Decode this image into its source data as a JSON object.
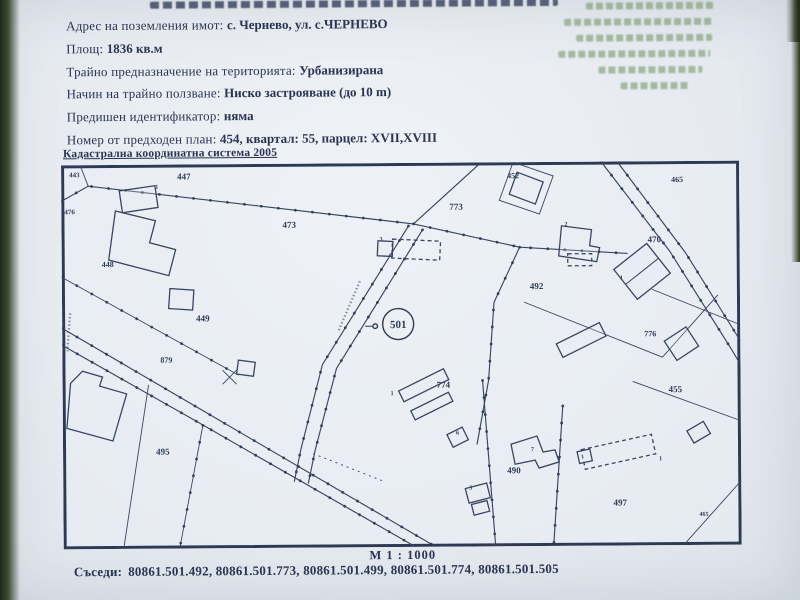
{
  "colors": {
    "paper": "#e9edf2",
    "ink": "#2a3453",
    "map_line": "#3a4560",
    "showthrough_green": "#6d8f5e",
    "photo_edge": "#1d2817"
  },
  "document": {
    "fields": [
      {
        "label": "Адрес на поземления имот:",
        "value": "с. Чернево, ул. с.ЧЕРНЕВО"
      },
      {
        "label": "Площ:",
        "value": "1836 кв.м"
      },
      {
        "label": "Трайно предназначение на територията:",
        "value": "Урбанизирана"
      },
      {
        "label": "Начин на трайно ползване:",
        "value": "Ниско застрояване (до 10 m)"
      },
      {
        "label": "Предишен идентификатор:",
        "value": "няма"
      },
      {
        "label": "Номер от предходен план:",
        "value": "454, квартал: 55, парцел: XVII,XVIII"
      }
    ],
    "coordinate_system_note": "Кадастрална координатна система 2005",
    "map": {
      "subject_parcel": "501",
      "scale_label": "М 1 : 1000",
      "parcel_labels": [
        {
          "t": "443",
          "x": 8,
          "y": 5,
          "s": 7
        },
        {
          "t": "447",
          "x": 116,
          "y": 6,
          "s": 9
        },
        {
          "t": "476",
          "x": 3,
          "y": 42,
          "s": 7
        },
        {
          "t": "473",
          "x": 221,
          "y": 55,
          "s": 9
        },
        {
          "t": "448",
          "x": 40,
          "y": 94,
          "s": 8
        },
        {
          "t": "449",
          "x": 134,
          "y": 148,
          "s": 9
        },
        {
          "t": "879",
          "x": 98,
          "y": 190,
          "s": 8
        },
        {
          "t": "495",
          "x": 93,
          "y": 281,
          "s": 9
        },
        {
          "t": "452",
          "x": 446,
          "y": 8,
          "s": 8
        },
        {
          "t": "773",
          "x": 388,
          "y": 38,
          "s": 9
        },
        {
          "t": "465",
          "x": 610,
          "y": 13,
          "s": 8
        },
        {
          "t": "470",
          "x": 586,
          "y": 72,
          "s": 9
        },
        {
          "t": "492",
          "x": 468,
          "y": 118,
          "s": 9
        },
        {
          "t": "776",
          "x": 582,
          "y": 167,
          "s": 8
        },
        {
          "t": "774",
          "x": 374,
          "y": 216,
          "s": 9
        },
        {
          "t": "455",
          "x": 606,
          "y": 222,
          "s": 9
        },
        {
          "t": "490",
          "x": 444,
          "y": 302,
          "s": 9
        },
        {
          "t": "497",
          "x": 550,
          "y": 335,
          "s": 9
        },
        {
          "t": "465",
          "x": 636,
          "y": 349,
          "s": 6
        },
        {
          "t": "1",
          "x": 94,
          "y": 18,
          "s": 6
        },
        {
          "t": "3",
          "x": 318,
          "y": 72,
          "s": 6
        },
        {
          "t": "2",
          "x": 503,
          "y": 58,
          "s": 6
        },
        {
          "t": "1",
          "x": 558,
          "y": 112,
          "s": 6
        },
        {
          "t": "1",
          "x": 328,
          "y": 226,
          "s": 6
        },
        {
          "t": "6",
          "x": 393,
          "y": 266,
          "s": 6
        },
        {
          "t": "7",
          "x": 468,
          "y": 283,
          "s": 6
        },
        {
          "t": "3",
          "x": 406,
          "y": 321,
          "s": 6
        },
        {
          "t": "1",
          "x": 596,
          "y": 293,
          "s": 6
        }
      ]
    },
    "neighbors": {
      "label": "Съседи:",
      "value": "80861.501.492, 80861.501.773, 80861.501.499, 80861.501.774, 80861.501.505"
    }
  }
}
